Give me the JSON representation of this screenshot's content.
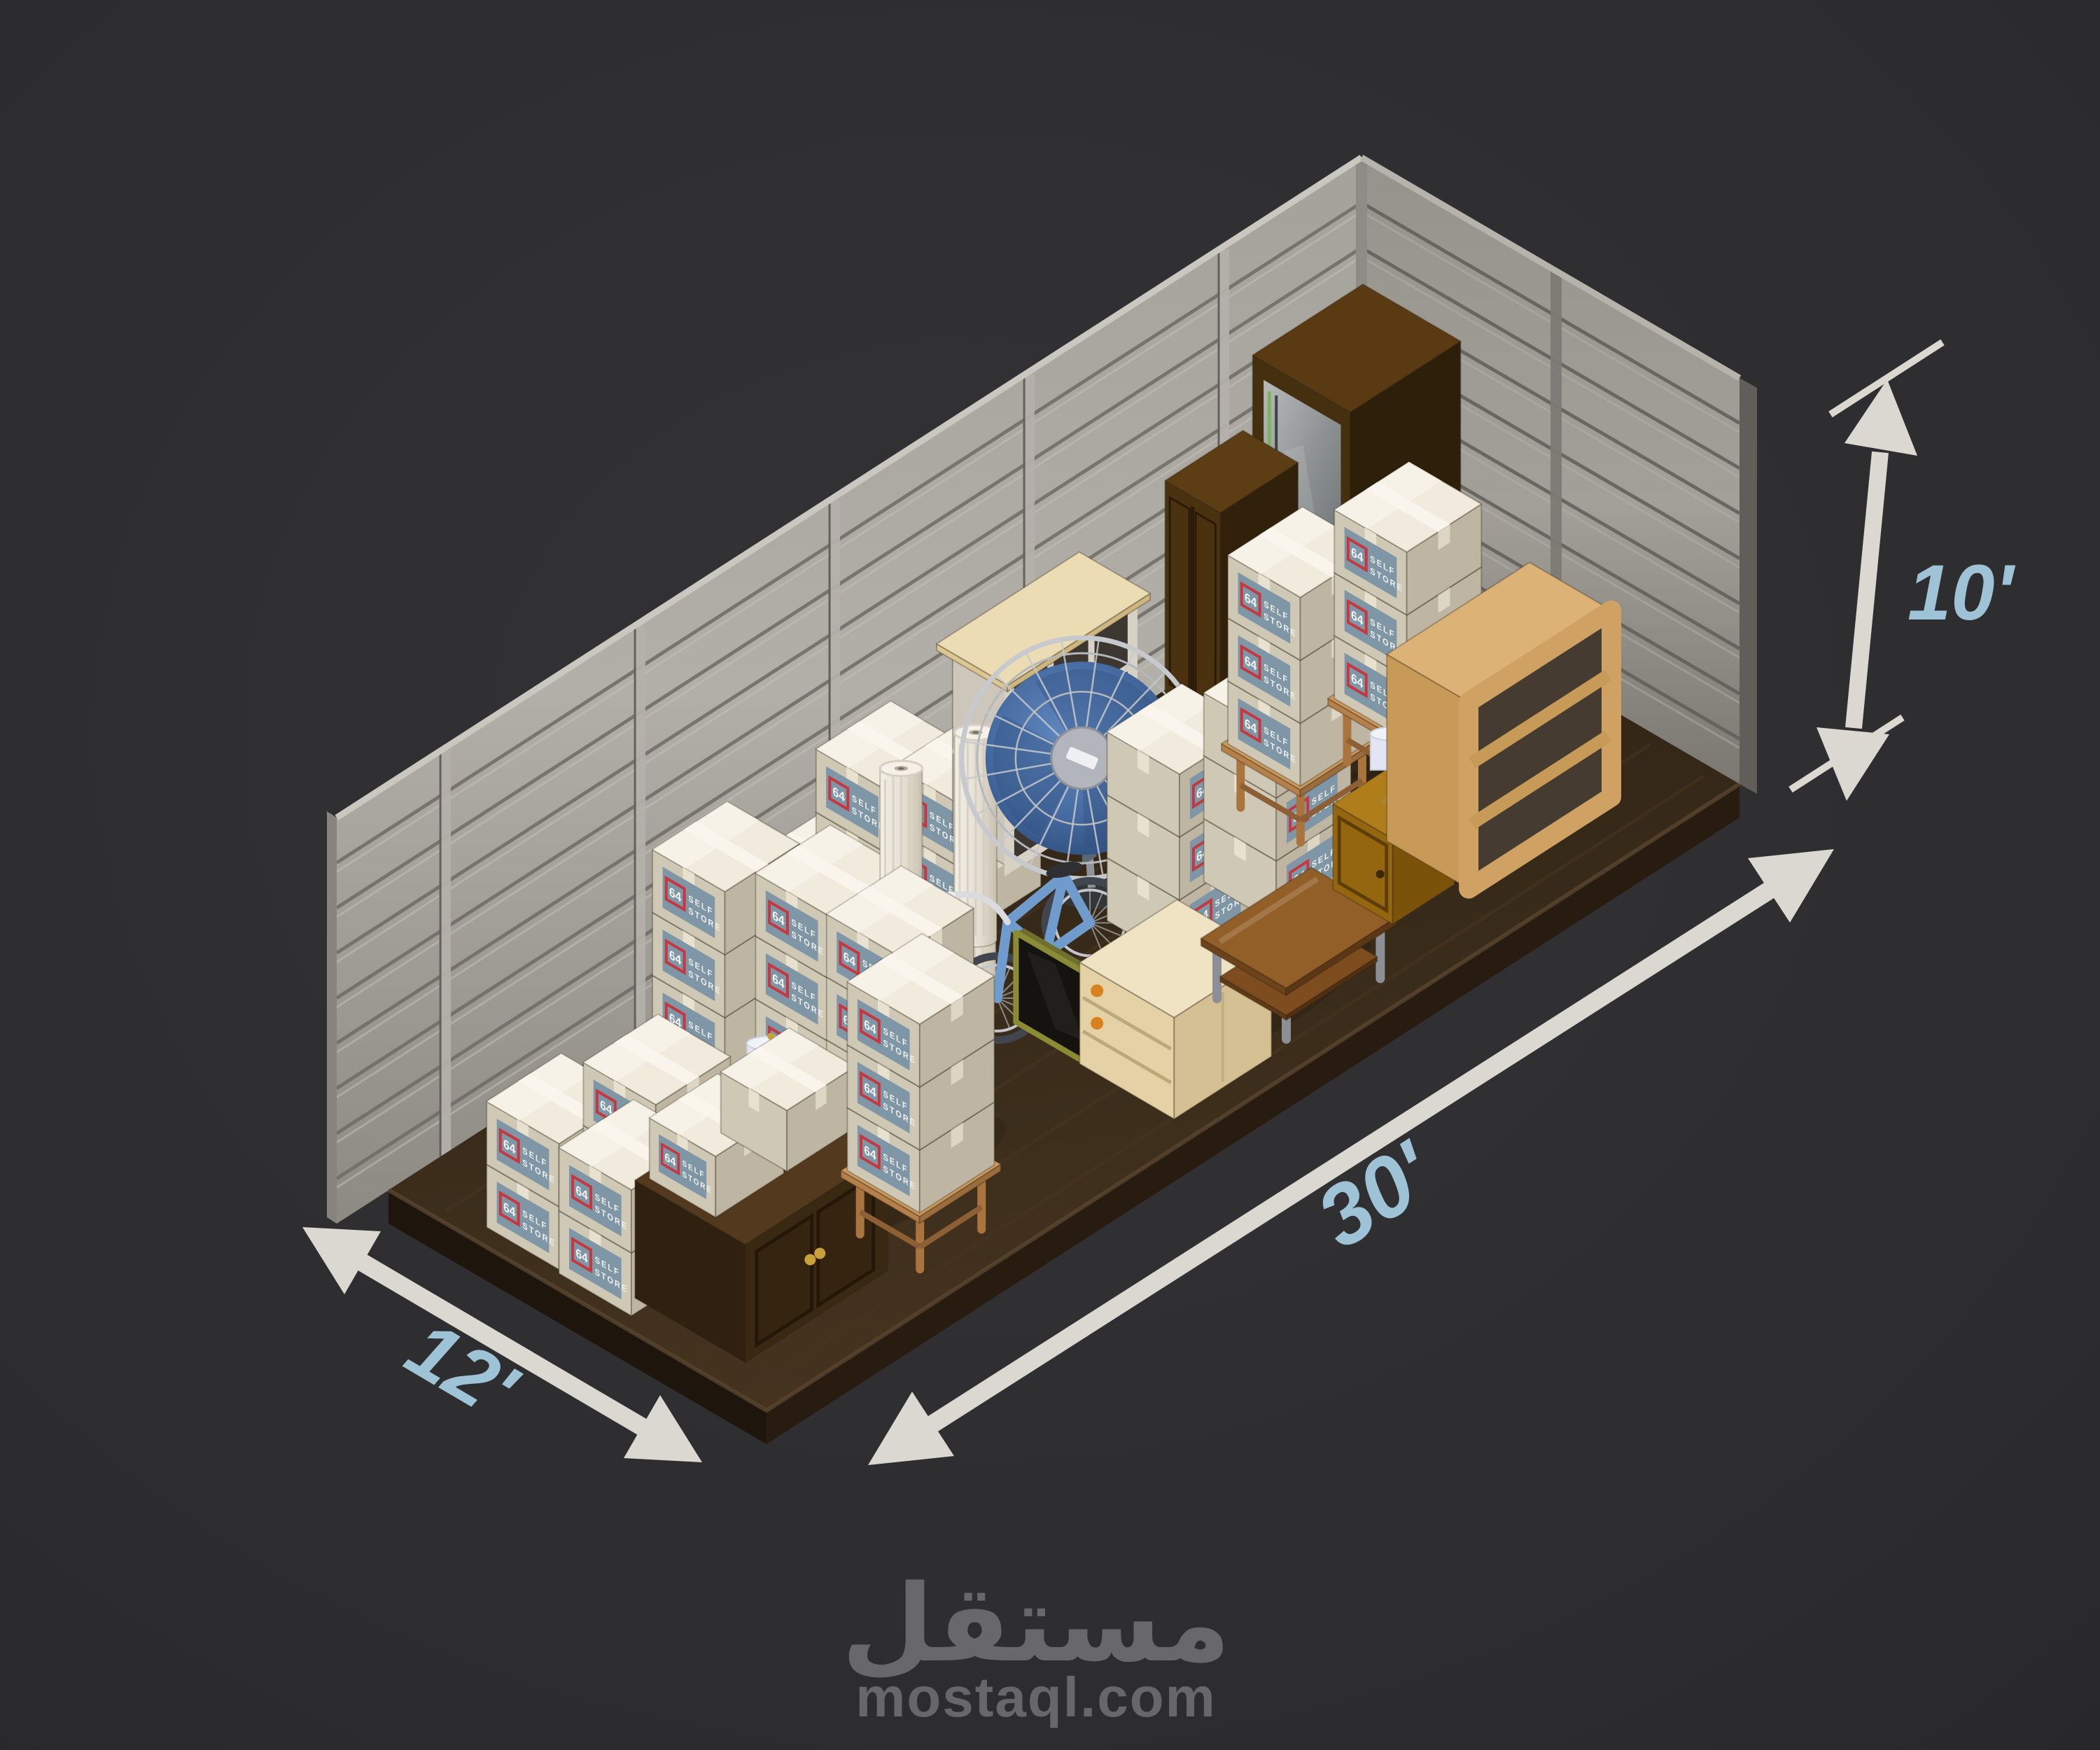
{
  "dimensions": {
    "height": "10'",
    "length": "30'",
    "width": "12'"
  },
  "box_label": {
    "number": "64",
    "line1": "SELF",
    "line2": "STORE"
  },
  "watermark": {
    "logo": "مستقل",
    "domain": "mostaql.com"
  },
  "colors": {
    "background": "#2d2d2f",
    "dimension_text": "#9fc3d6",
    "arrow": "#dad8d0",
    "box_label_bg": "#7e96a6",
    "box_label_accent": "#c5383f",
    "box_body": "#cfc8b5",
    "wall_metal": "#a29e98",
    "floor_wood": "#36281a",
    "watermark_gray": "#68686b"
  }
}
